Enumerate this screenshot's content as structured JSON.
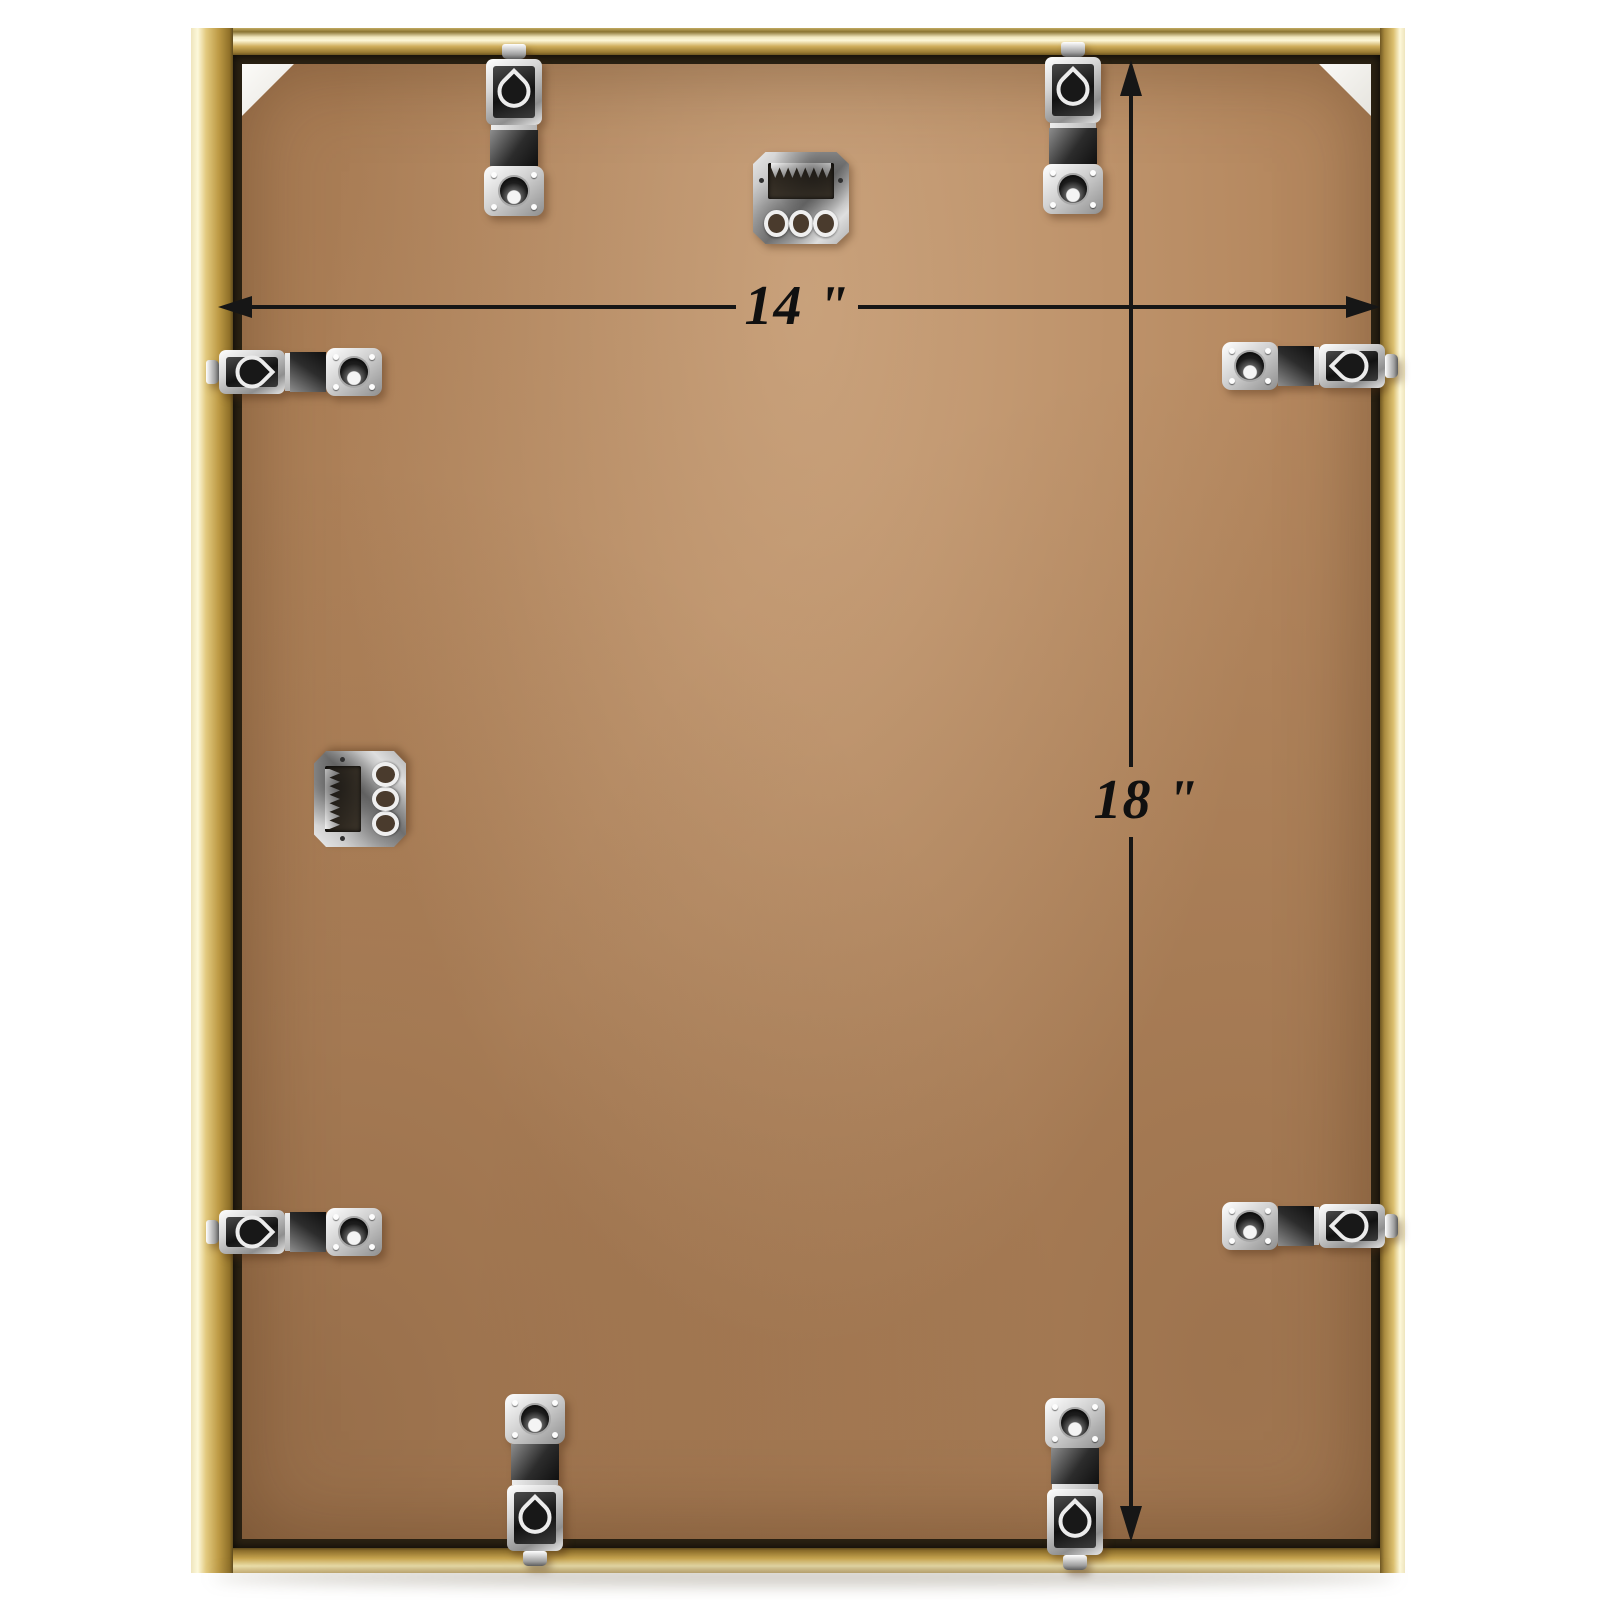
{
  "page": {
    "description": "Back view of a gold aluminum picture frame with MDF backing board, hanging hardware and dimension arrows"
  },
  "dimensions": {
    "width_label": "14 \"",
    "height_label": "18 \""
  },
  "colors": {
    "background": "#ffffff",
    "frame_gold": "#c9a84f",
    "frame_gold_highlight": "#fdf8da",
    "frame_channel_dark": "#2b2213",
    "board_brown": "#b5885f",
    "hardware_silver": "#d9d9d9",
    "annotation_black": "#161616",
    "corner_spacer_white": "#f5f4f0"
  },
  "hardware": {
    "hanging_clips_count": 8,
    "sawtooth_hangers_count": 2
  }
}
